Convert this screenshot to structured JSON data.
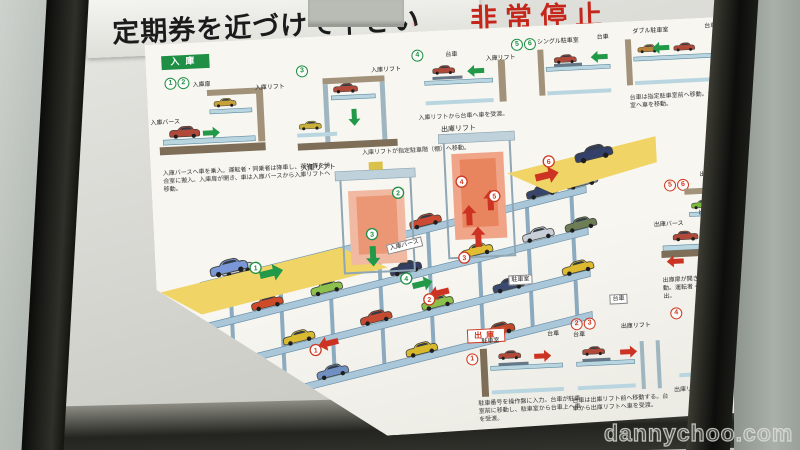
{
  "sign": {
    "instruction": "定期券を近づけて下さい",
    "instruction_partial": "PLEASE",
    "emergency": "非常停止"
  },
  "watermark": "dannychoo.com",
  "poster": {
    "entry": {
      "badge": "入庫",
      "steps": [
        "1",
        "2",
        "3",
        "4",
        "5",
        "6"
      ],
      "labels": {
        "door": "入庫扉",
        "berth": "入庫バース",
        "lift": "入庫リフト",
        "dolly": "台車",
        "single_room": "シングル駐車室",
        "double_room": "ダブル駐車室"
      },
      "note": "入庫バースへ車を乗入。運転者・同乗者は降車し、荷物等を待合室に搬入。入庫扉が開き、車は入庫バースから入庫リフトへ移動。",
      "caption_lift": "入庫リフトが指定駐車階（棚）へ移動。",
      "caption_dolly": "入庫リフトから台車へ車を受渡。",
      "caption_room": "台車は指定駐車室前へ移動。台車から駐車室へ車を移動。"
    },
    "diagram": {
      "entry_lift": "入庫リフト",
      "entry_berth": "入庫バース",
      "exit_lift": "出庫リフト",
      "room": "駐車室",
      "dolly": "台車",
      "entry_steps": [
        "1",
        "2",
        "3",
        "4"
      ],
      "exit_steps": [
        "1",
        "2",
        "3",
        "4",
        "5",
        "6"
      ]
    },
    "exit_berth": {
      "steps": [
        "5",
        "6"
      ],
      "lift": "出庫リフト",
      "door": "出庫扉",
      "berth": "出庫バース",
      "caption": "出庫扉が開き、出庫バースへ車を移動。運転者・同乗者が乗車し、退出。"
    },
    "exit": {
      "badge": "出庫",
      "steps": [
        "1",
        "2",
        "3",
        "4"
      ],
      "labels": {
        "room": "駐車室",
        "dolly": "台車",
        "lift": "出庫リフト"
      },
      "caption_room": "駐車番号を操作盤に入力。台車が駐車室前に移動し、駐車室から台車上へ車を受渡。",
      "caption_lift": "台車は出庫リフト前へ移動する。台車から出庫リフトへ車を受渡。",
      "caption_move": "出庫リフトが出庫バース階へ移動。"
    }
  }
}
